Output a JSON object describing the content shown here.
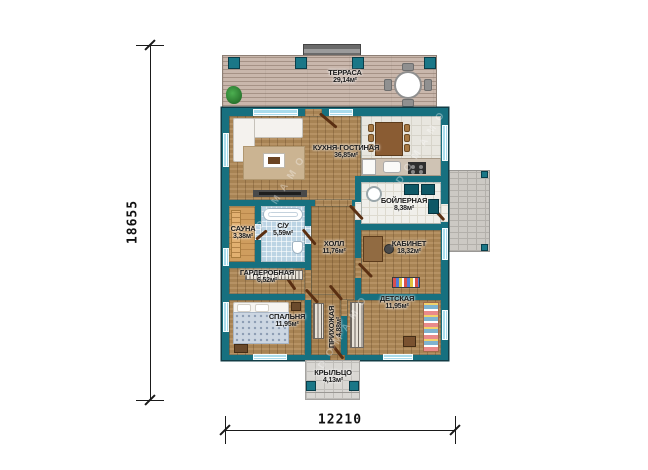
{
  "title": "Одноэтажный дом — план этажа",
  "watermark": {
    "text": "DOMAMO"
  },
  "dimensions": {
    "height_label": "18655",
    "width_label": "12210"
  },
  "rooms": [
    {
      "id": "terrace",
      "name": "ТЕРРАСА",
      "area": "29,14м²"
    },
    {
      "id": "kitchen_living",
      "name": "КУХНЯ-ГОСТИНАЯ",
      "area": "36,85м²"
    },
    {
      "id": "boiler",
      "name": "БОЙЛЕРНАЯ",
      "area": "8,38м²"
    },
    {
      "id": "bathroom",
      "name": "С/У",
      "area": "5,59м²"
    },
    {
      "id": "sauna",
      "name": "САУНА",
      "area": "3,38м²"
    },
    {
      "id": "hall",
      "name": "ХОЛЛ",
      "area": "11,76м²"
    },
    {
      "id": "cabinet",
      "name": "КАБИНЕТ",
      "area": "18,32м²"
    },
    {
      "id": "wardrobe",
      "name": "ГАРДЕРОБНАЯ",
      "area": "6,52м²"
    },
    {
      "id": "bedroom",
      "name": "СПАЛЬНЯ",
      "area": "11,95м²"
    },
    {
      "id": "children",
      "name": "ДЕТСКАЯ",
      "area": "11,95м²"
    },
    {
      "id": "entry",
      "name": "ПРИХОЖАЯ",
      "area": "4,88м²"
    },
    {
      "id": "porch",
      "name": "КРЫЛЬЦО",
      "area": "4,13м²"
    }
  ],
  "colors": {
    "wall": "#17707f",
    "wood": "#b08a58",
    "sauna_wood": "#cf9d5e",
    "bath_tile": "#bcd4e4",
    "kitchen_tile": "#e8e6df",
    "boiler_tile": "#f0efea",
    "deck": "#c9b7ac",
    "paving": "#d9d7d3",
    "window": "#a9dcec",
    "door": "#5a2f12"
  }
}
